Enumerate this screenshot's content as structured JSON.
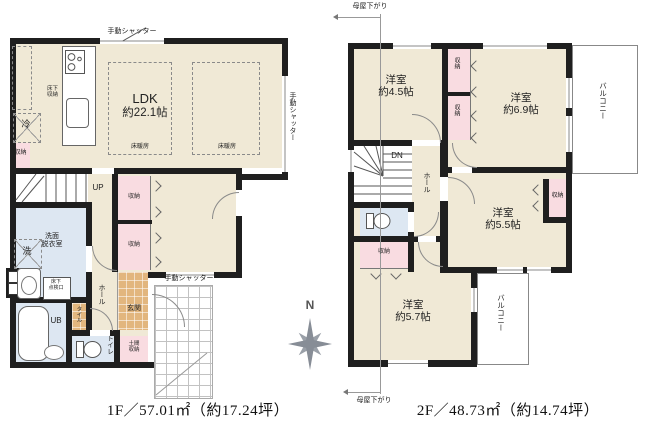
{
  "colors": {
    "wall": "#1f1f1f",
    "floor": "#f0e9d6",
    "closet": "#f9dce1",
    "wet": "#dde7f2",
    "tile": "#e2b67e"
  },
  "compass_label": "N",
  "floor1": {
    "caption": "1F／57.01㎡（約17.24坪）",
    "shutter": "手動シャッター",
    "ldk": {
      "name": "LDK",
      "size": "約22.1帖"
    },
    "floor_heating": "床暖房",
    "underfloor_storage": {
      "l1": "床下",
      "l2": "収納"
    },
    "fridge": "冷",
    "storage": "収納",
    "up": "UP",
    "washroom": {
      "l1": "洗面",
      "l2": "脱衣室"
    },
    "washer": "洗",
    "inspection": {
      "l1": "床下",
      "l2": "点検口"
    },
    "bath": "UB",
    "toilet": "トイレ",
    "hall": "ホール",
    "entrance": "玄関",
    "tile_strip": "タイル",
    "doma": {
      "l1": "土間",
      "l2": "収納"
    }
  },
  "floor2": {
    "caption": "2F／48.73㎡（約14.74坪）",
    "moya": "母屋下がり",
    "rooms": {
      "r45": {
        "name": "洋室",
        "size": "約4.5帖"
      },
      "r69": {
        "name": "洋室",
        "size": "約6.9帖"
      },
      "r55": {
        "name": "洋室",
        "size": "約5.5帖"
      },
      "r57": {
        "name": "洋室",
        "size": "約5.7帖"
      }
    },
    "balcony": "バルコニー",
    "dn": "DN",
    "hall": "ホール",
    "storage": "収納"
  }
}
